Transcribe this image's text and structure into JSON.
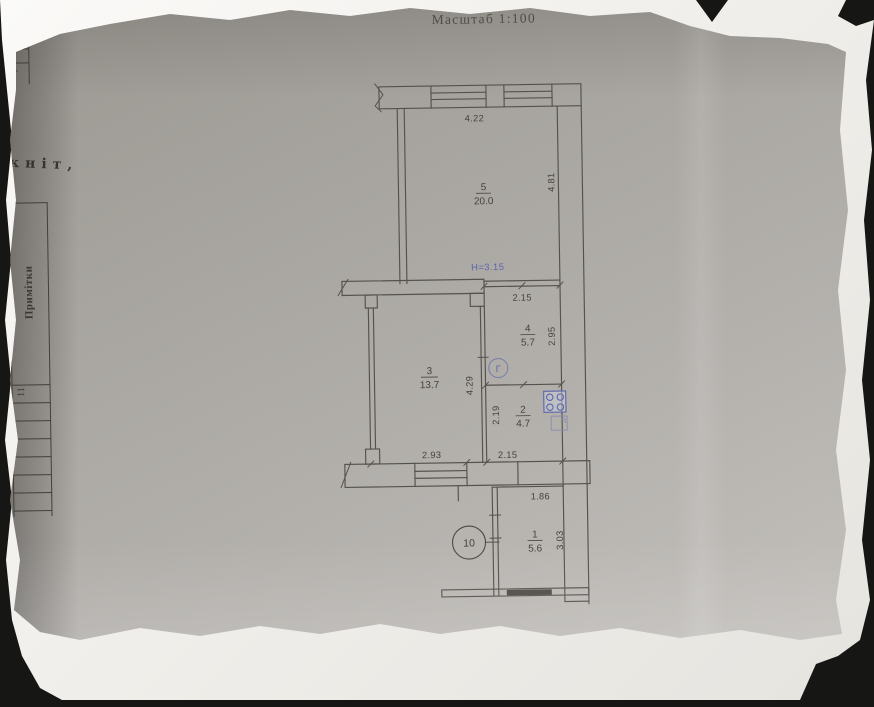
{
  "header": {
    "scale_label": "Масштаб 1:100"
  },
  "fragments": {
    "corner_value": "2",
    "handwritten": "кніт,",
    "notes_header": "Примітки",
    "notes_row": "11"
  },
  "floor_plan": {
    "height_note": "Н=3.15",
    "gas_marker": "Г",
    "node_marker": "10",
    "colors": {
      "ink": "#55524d",
      "blue_ink": "#5965ab"
    },
    "rooms": [
      {
        "number": "5",
        "area": "20.0",
        "width": "4.22",
        "depth": "4.81"
      },
      {
        "number": "4",
        "area": "5.7",
        "width": "2.15",
        "depth": "2.95"
      },
      {
        "number": "3",
        "area": "13.7",
        "width": "2.93",
        "depth": "4.29"
      },
      {
        "number": "2",
        "area": "4.7",
        "width": "2.15",
        "depth": "2.19"
      },
      {
        "number": "1",
        "area": "5.6",
        "width": "1.86",
        "depth": "3.03"
      }
    ]
  }
}
